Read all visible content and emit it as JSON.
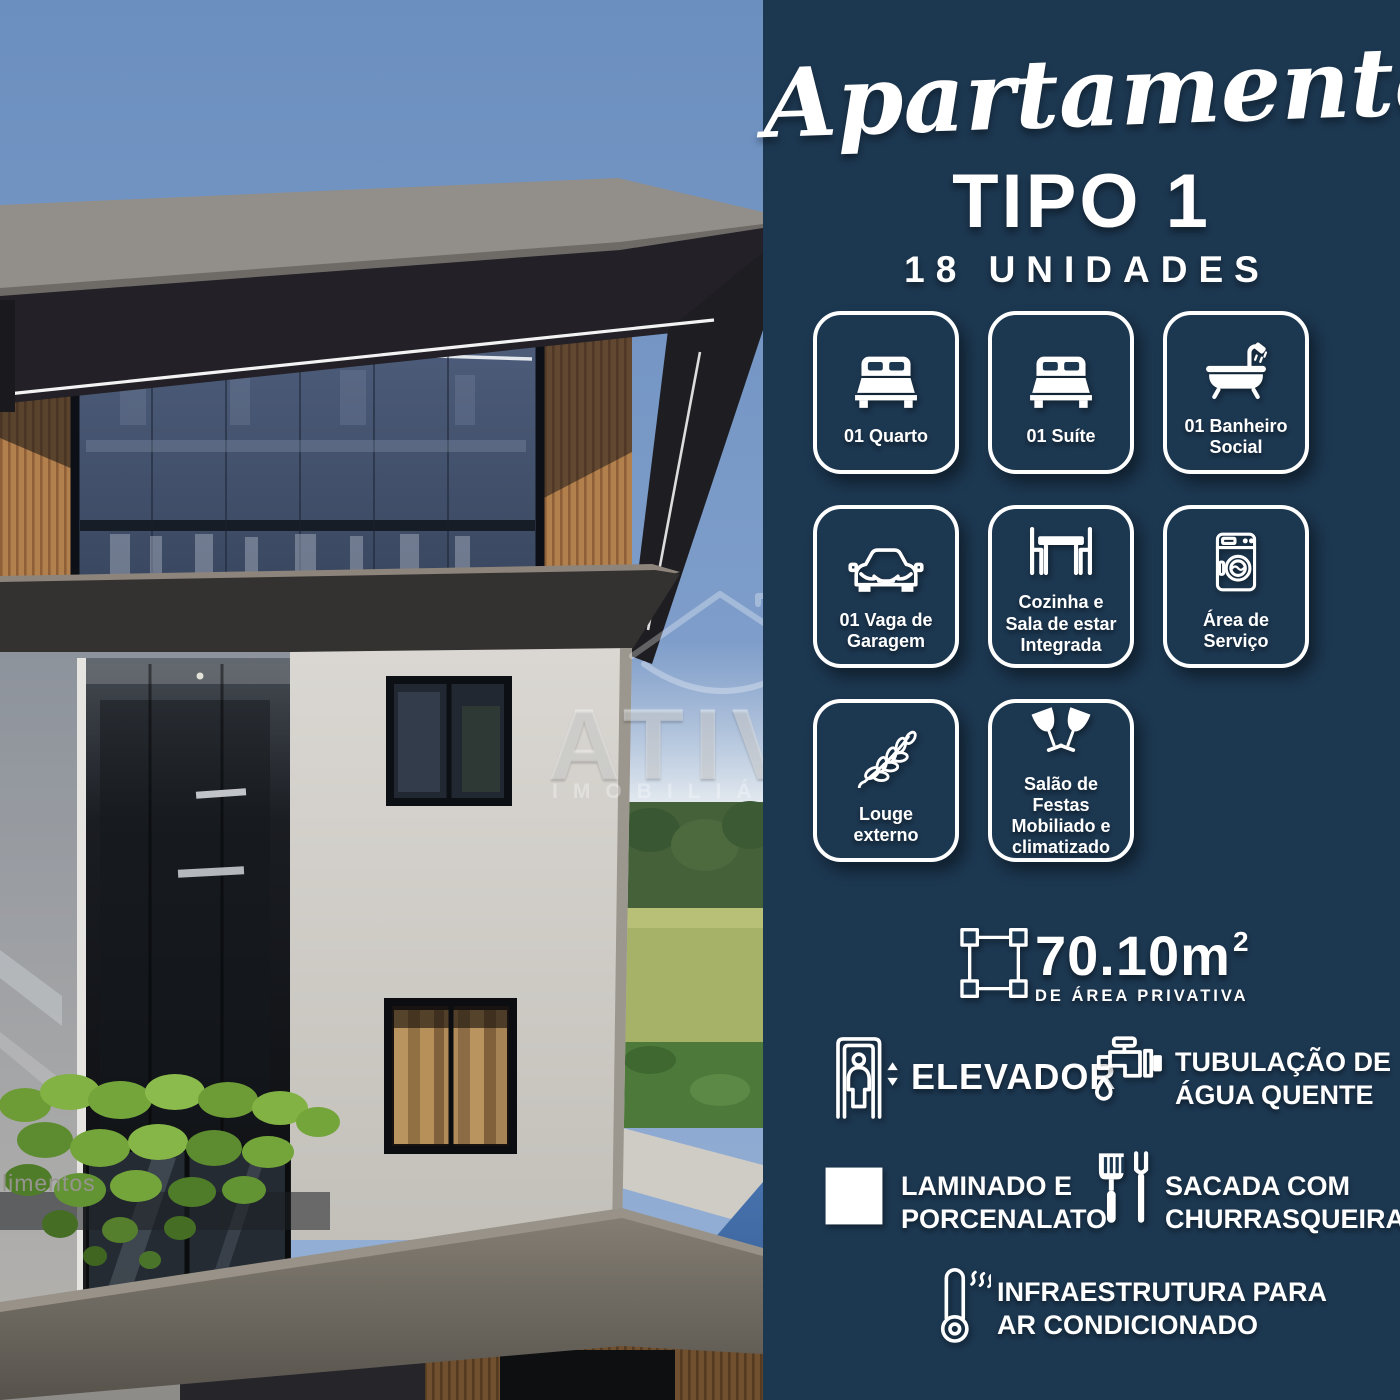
{
  "panel": {
    "title_script": "Apartamento",
    "title_type": "TIPO 1",
    "units": "18 UNIDADES",
    "colors": {
      "background": "#1c3750",
      "text": "#ffffff"
    },
    "cards": [
      {
        "icon": "double-bed-icon",
        "label": "01 Quarto"
      },
      {
        "icon": "double-bed-icon",
        "label": "01 Suíte"
      },
      {
        "icon": "bathtub-shower-icon",
        "label": "01 Banheiro\nSocial"
      },
      {
        "icon": "car-icon",
        "label": "01 Vaga de\nGaragem"
      },
      {
        "icon": "dining-table-icon",
        "label": "Cozinha e\nSala de estar\nIntegrada"
      },
      {
        "icon": "washing-machine-icon",
        "label": "Área de\nServiço"
      },
      {
        "icon": "leaf-branch-icon",
        "label": "Louge\nexterno"
      },
      {
        "icon": "toast-glasses-icon",
        "label": "Salão de Festas\nMobiliado e\nclimatizado"
      }
    ],
    "area": {
      "value": "70.10m",
      "sup": "2",
      "caption": "DE ÁREA PRIVATIVA",
      "icon": "area-dimension-icon"
    },
    "features": [
      {
        "icon": "elevator-icon",
        "label": "ELEVADOR"
      },
      {
        "icon": "faucet-icon",
        "label": "TUBULAÇÃO DE\nÁGUA QUENTE"
      },
      {
        "icon": "floor-tile-icon",
        "label": "LAMINADO E\nPORCENALATO"
      },
      {
        "icon": "grill-tools-icon",
        "label": "SACADA COM\nCHURRASQUEIRA"
      },
      {
        "icon": "thermometer-icon",
        "label": "INFRAESTRUTURA PARA\nAR CONDICIONADO"
      }
    ]
  },
  "photo": {
    "description": "3D render of modern apartment building",
    "watermark_brand": "ATIVA",
    "watermark_sub": "IMOBILIÁRIA",
    "wall_text": "limentos"
  }
}
